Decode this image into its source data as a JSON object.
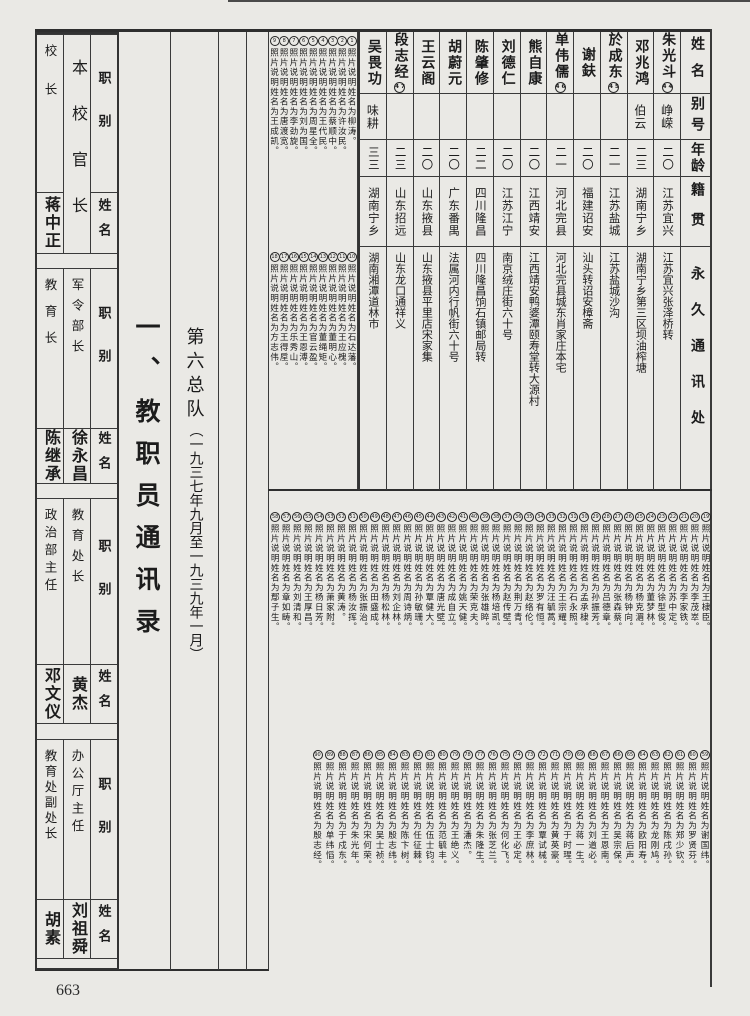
{
  "page": {
    "number": "663"
  },
  "section_title": "一、教职员通讯录",
  "subtitle": {
    "main": "第六总队",
    "paren": "（一九三七年九月至一九三九年一月）"
  },
  "officials_table": {
    "span_header": "本校官长",
    "role_label": "职别",
    "name_label": "姓名",
    "sections": [
      {
        "left_role": "校长",
        "left_name": "蒋中正",
        "mid_role": "",
        "mid_name": "",
        "span": true
      },
      {
        "left_role": "教育长",
        "left_name": "陈继承",
        "mid_role": "军令部长",
        "mid_name": "徐永昌",
        "span": false
      },
      {
        "left_role": "政治部主任",
        "left_name": "邓文仪",
        "mid_role": "教育处长",
        "mid_name": "黄杰",
        "span": false
      },
      {
        "left_role": "教育处副处长",
        "left_name": "胡素",
        "mid_role": "办公厅主任",
        "mid_name": "刘祖舜",
        "span": false
      }
    ]
  },
  "directory_table": {
    "headers": {
      "name": "姓名",
      "alias": "别号",
      "age": "年龄",
      "native": "籍贯",
      "address": "永久通讯处"
    },
    "rows": [
      {
        "name": "朱光斗",
        "mark": "44",
        "alias": "峥嵘",
        "age": "二〇",
        "native": "江苏宜兴",
        "address": "江苏宜兴张泽桥转"
      },
      {
        "name": "邓兆鸿",
        "mark": "",
        "alias": "伯云",
        "age": "二三",
        "native": "湖南宁乡",
        "address": "湖南宁乡第三区坝油榨塘"
      },
      {
        "name": "於成东",
        "mark": "45",
        "alias": "",
        "age": "二一",
        "native": "江苏盐城",
        "address": "江苏盐城沙沟"
      },
      {
        "name": "谢鈇",
        "mark": "",
        "alias": "",
        "age": "二〇",
        "native": "福建诏安",
        "address": "汕头转诏安樟斋"
      },
      {
        "name": "单伟儒",
        "mark": "46",
        "alias": "",
        "age": "二一",
        "native": "河北完县",
        "address": "河北完县城东肖家庄本宅"
      },
      {
        "name": "熊自康",
        "mark": "",
        "alias": "",
        "age": "二〇",
        "native": "江西靖安",
        "address": "江西靖安鸭婆潭颐寿堂转大源村"
      },
      {
        "name": "刘德仁",
        "mark": "",
        "alias": "",
        "age": "二〇",
        "native": "江苏江宁",
        "address": "南京绒庄街六十号"
      },
      {
        "name": "陈肇修",
        "mark": "",
        "alias": "",
        "age": "二二",
        "native": "四川隆昌",
        "address": "四川隆昌饷石镇邮局转"
      },
      {
        "name": "胡蔚元",
        "mark": "",
        "alias": "",
        "age": "二〇",
        "native": "广东番禺",
        "address": "法属河内行帆街六十号"
      },
      {
        "name": "王云阁",
        "mark": "",
        "alias": "",
        "age": "二〇",
        "native": "山东掖县",
        "address": "山东掖县平里店宋家集"
      },
      {
        "name": "段志经",
        "mark": "47",
        "alias": "",
        "age": "二三",
        "native": "山东招远",
        "address": "山东龙口通祥义"
      },
      {
        "name": "吴畏功",
        "mark": "",
        "alias": "味耕",
        "age": "三三",
        "native": "湖南宁乡",
        "address": "湖南湘潭道林市"
      }
    ]
  },
  "footnotes": {
    "prefix": "照片说明姓名为",
    "suffix": "。",
    "block1_start": 1,
    "block1": [
      "柳涛",
      "许汝民",
      "蔡顺中",
      "王代民",
      "周星全",
      "刘为国",
      "李劲旋",
      "唐渡宽",
      "王成凯"
    ],
    "block2_start": 10,
    "block2": [
      "石达藩",
      "王应槐",
      "董明心",
      "董绳矩",
      "官云盈",
      "王恩溥",
      "乐秀山",
      "王得垕",
      "方志伟"
    ],
    "block3_start": 19,
    "block3": [
      "王棣臣",
      "李茂崒",
      "李家铁",
      "苏中定",
      "徐型俊",
      "董梦林",
      "杨克湄",
      "杨钟向",
      "张森蔡",
      "吕德章",
      "孙振芳",
      "孟承棣",
      "石永照",
      "王宗耀",
      "汪毓蒿",
      "罗有恒",
      "赵络伦",
      "荆万青",
      "赵传壁",
      "杨培凯",
      "张雄睟",
      "荣克夫",
      "姚天健",
      "成自立",
      "唐光壁",
      "覃健大",
      "孙敏珊",
      "周诗炳",
      "刘企林",
      "杨松林",
      "田盛成",
      "张振治",
      "杨汝挥",
      "黄涛",
      "萧家附",
      "杨日芳",
      "王厚昌",
      "刘清和",
      "章如畴",
      "鄢子生"
    ],
    "block4_start": 59,
    "block4": [
      "谢国纬",
      "罗贤芬",
      "郑少钦",
      "陈戌孙",
      "龙刚鸠",
      "欧阳寿",
      "蒋后声",
      "吴宗保",
      "王恩南",
      "刘道必",
      "蒋一生",
      "于时瑆",
      "黄英豪",
      "覃试械",
      "李庶林",
      "王必定",
      "何化飞",
      "张芝兰",
      "朱隆生",
      "潘杰",
      "王绝义",
      "范毓丰",
      "伍士钧",
      "任征棘",
      "陈卞树",
      "殷志纬",
      "吴士祯",
      "宋何荣",
      "朱光年",
      "于戍东",
      "单纬慆",
      "殷志经"
    ]
  }
}
